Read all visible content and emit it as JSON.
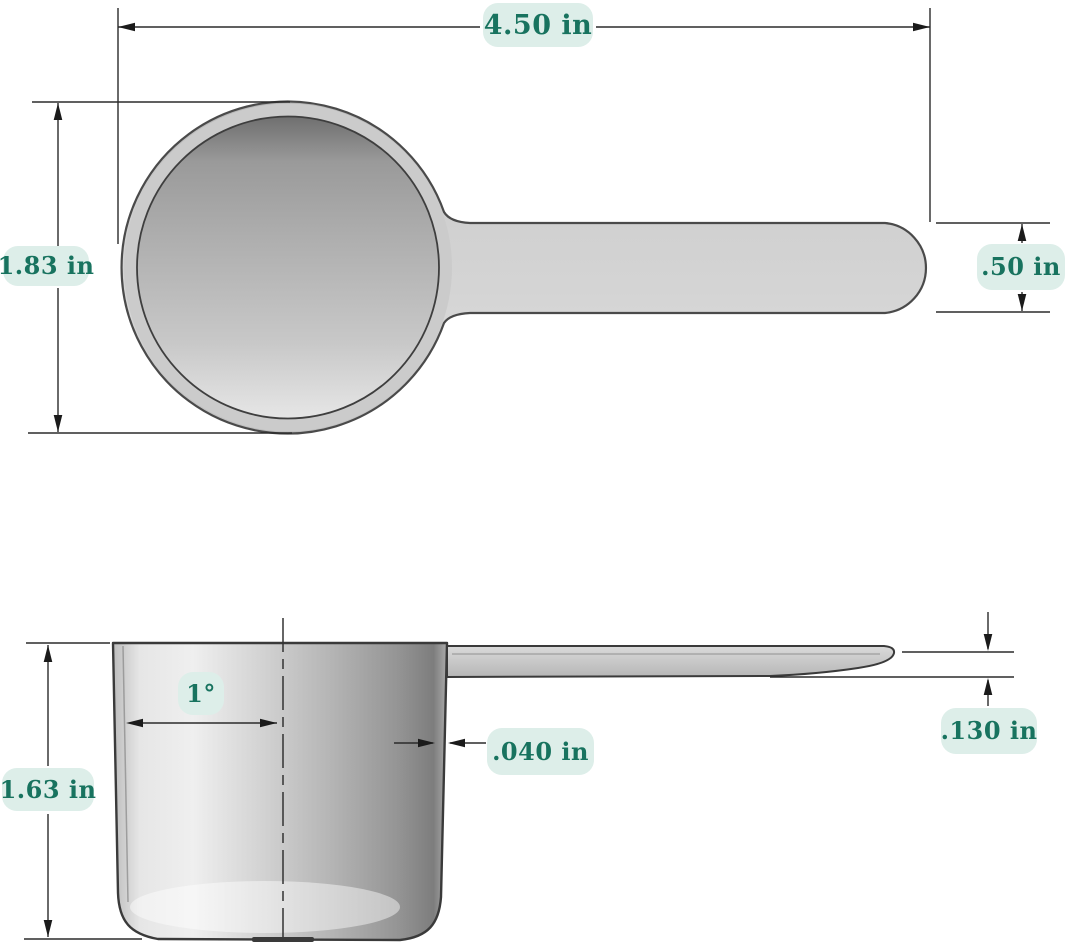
{
  "drawing": {
    "subject": "measuring scoop technical drawing",
    "views": [
      "top-view",
      "side-section-view"
    ]
  },
  "colors": {
    "label_bg": "#ddeee9",
    "label_text": "#18735f",
    "line_color": "#2b2b2b"
  },
  "dims": {
    "overall_length": "4.50 in",
    "bowl_diameter": "1.83 in",
    "handle_width": ".50 in",
    "cup_height": "1.63 in",
    "draft_angle": "1°",
    "wall_thickness": ".040 in",
    "handle_thickness": ".130 in"
  }
}
